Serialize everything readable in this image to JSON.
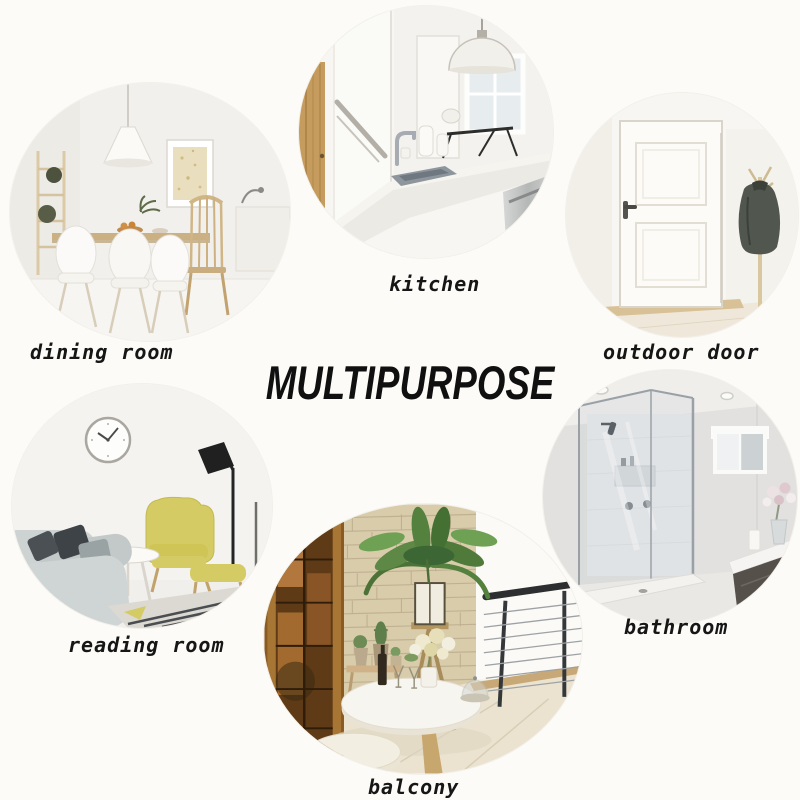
{
  "title": "MULTIPURPOSE",
  "rooms": [
    {
      "id": "dining-room",
      "label": "dining room"
    },
    {
      "id": "kitchen",
      "label": "kitchen"
    },
    {
      "id": "outdoor-door",
      "label": "outdoor door"
    },
    {
      "id": "reading-room",
      "label": "reading room"
    },
    {
      "id": "bathroom",
      "label": "bathroom"
    },
    {
      "id": "balcony",
      "label": "balcony"
    }
  ],
  "style": {
    "background": "#fcfbf7",
    "text_color": "#161616",
    "chair_yellow": "#d5cb64",
    "stone_wall": "#d9ccab",
    "wood_brown": "#a87634",
    "jacket_gray": "#51564f"
  }
}
